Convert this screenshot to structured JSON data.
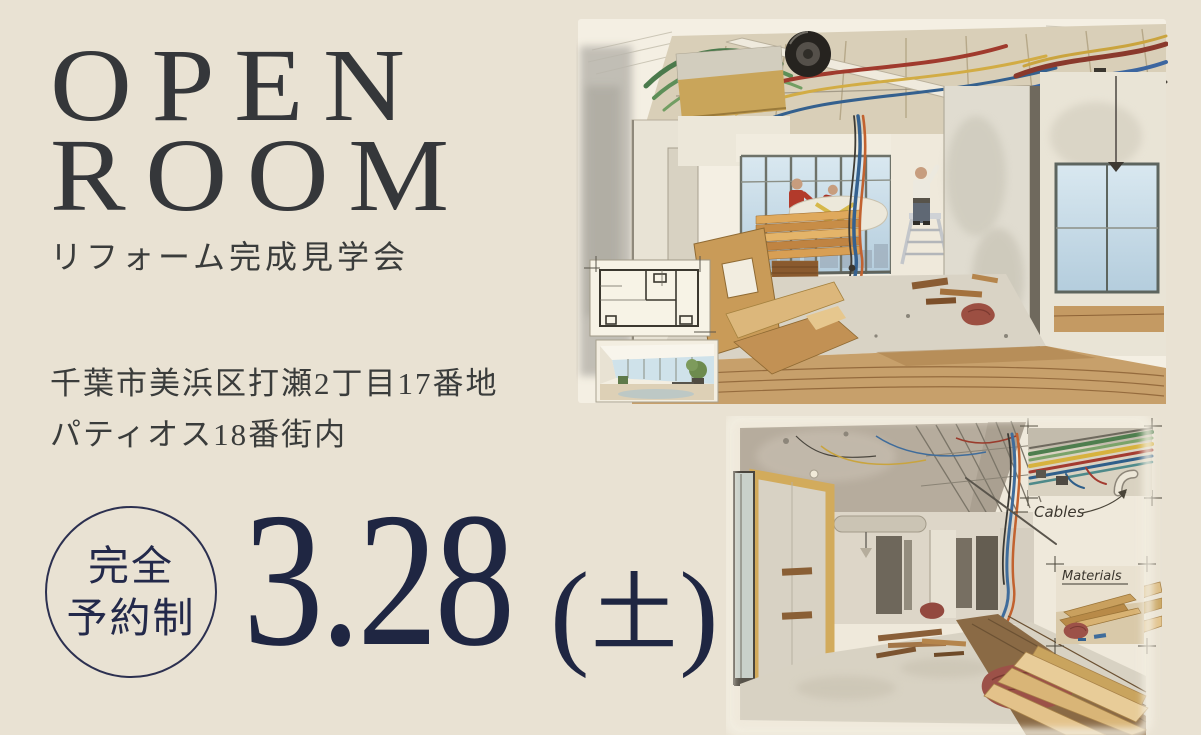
{
  "page": {
    "background_color": "#e9e2d3"
  },
  "hero": {
    "title_line1": "OPEN",
    "title_line2": "ROOM",
    "subtitle": "リフォーム完成見学会"
  },
  "venue": {
    "address_line1": "千葉市美浜区打瀬2丁目17番地",
    "address_line2": "パティオス18番街内"
  },
  "reservation_badge": {
    "line1": "完全",
    "line2": "予約制"
  },
  "event_date": {
    "date": "3.28",
    "paren_open": "(",
    "weekday": "土",
    "paren_close": ")"
  },
  "colors": {
    "background": "#e9e2d3",
    "text_dark": "#35373a",
    "navy": "#1f2642",
    "illustration_paper": "#f4efe3",
    "accent_red": "#b23a2b",
    "wood": "#c9a55a"
  },
  "illustrations": {
    "top": {
      "name": "renovation-progress-illustration"
    },
    "bottom": {
      "name": "gutted-room-illustration",
      "cables_label": "Cables",
      "materials_label": "Materials"
    }
  }
}
